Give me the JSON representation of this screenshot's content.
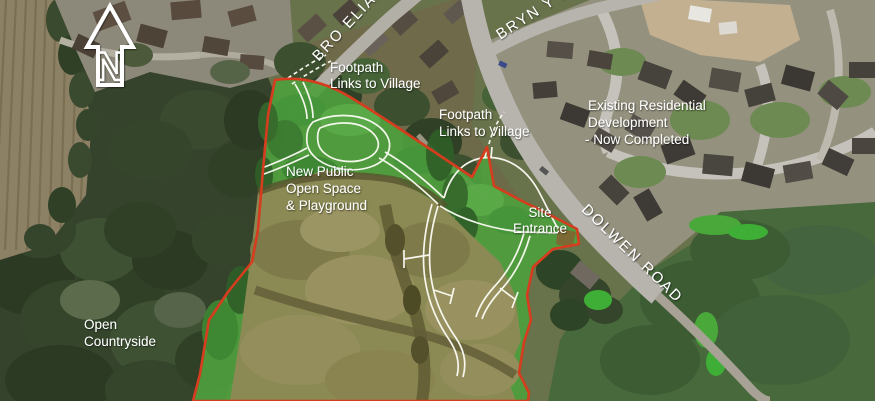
{
  "annotations": {
    "footpath_link_top": {
      "line1": "Footpath",
      "line2": "Links to Village"
    },
    "footpath_link_mid": {
      "line1": "Footpath",
      "line2": "Links to Village"
    },
    "existing_residential": {
      "line1": "Existing Residential",
      "line2": "Development",
      "line3": "- Now Completed"
    },
    "open_space": {
      "line1": "New Public",
      "line2": "Open Space",
      "line3": "& Playground"
    },
    "site_entrance": {
      "line1": "Site",
      "line2": "Entrance"
    },
    "open_countryside": {
      "line1": "Open",
      "line2": "Countryside"
    }
  },
  "road_names": {
    "bro_elian": "BRO ELIAN",
    "bryn_y_maen": "BRYN Y M",
    "dolwen_road": "DOLWEN ROAD"
  },
  "compass": {
    "letter": "N"
  },
  "colors": {
    "site_boundary_red": "#d63c1e",
    "open_space_green": "#4f9e3e",
    "field_olive": "#8e8955",
    "label_white": "#ffffff",
    "road_grey": "#b6b4ad",
    "woodland_dark_green": "#35422c",
    "proposed_road_white": "#fdfdf5"
  }
}
